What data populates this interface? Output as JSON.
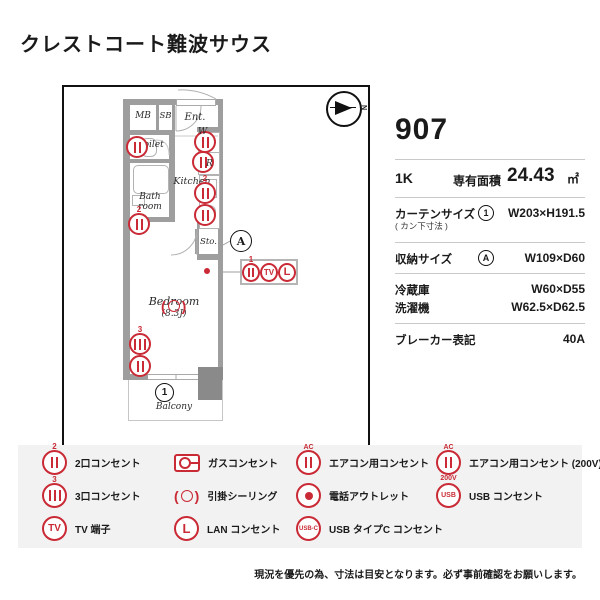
{
  "title": "クレストコート難波サウス",
  "info": {
    "room_number": "907",
    "layout": "1K",
    "area_label": "専有面積",
    "area_value": "24.43",
    "area_unit": "㎡",
    "curtain_label": "カーテンサイズ",
    "curtain_sublabel": "( カン下寸法 )",
    "curtain_ref": "1",
    "curtain_value": "W203×H191.5",
    "storage_label": "収納サイズ",
    "storage_ref": "A",
    "storage_value": "W109×D60",
    "fridge_label": "冷蔵庫",
    "fridge_value": "W60×D55",
    "washer_label": "洗濯機",
    "washer_value": "W62.5×D62.5",
    "breaker_label": "ブレーカー表記",
    "breaker_value": "40A"
  },
  "plan": {
    "compass": "N",
    "rooms": {
      "mb": "MB",
      "sb": "SB",
      "ent": "Ent.",
      "toilet": "Toilet",
      "kitchen": "Kitchen",
      "bath_line1": "Bath",
      "bath_line2": "room",
      "storage": "Sto.",
      "bedroom": "Bedroom",
      "bedroom_size": "(8.3J)",
      "balcony": "Balcony"
    },
    "markers": {
      "washer": "W",
      "fridge": "R",
      "storage_ref": "A",
      "balcony_ref": "1",
      "kitchen_outlet_count": "2",
      "bath_outlet_count": "2",
      "bedroom_outlet_count": "3",
      "callout_outlet_count": "1",
      "tv": "TV",
      "lan": "L"
    }
  },
  "legend": {
    "items": [
      {
        "label": "2口コンセント",
        "count": "2"
      },
      {
        "label": "ガスコンセント"
      },
      {
        "label": "エアコン用コンセント",
        "top": "AC"
      },
      {
        "label": "エアコン用コンセント (200V)",
        "top": "AC",
        "bottom": "200V"
      },
      {
        "label": "3口コンセント",
        "count": "3"
      },
      {
        "label": "引掛シーリング"
      },
      {
        "label": "電話アウトレット"
      },
      {
        "label": "USB コンセント",
        "text": "USB"
      },
      {
        "label": "TV 端子",
        "text": "TV"
      },
      {
        "label": "LAN コンセント",
        "text": "L"
      },
      {
        "label": "USB タイプC コンセント",
        "text": "USB-C"
      }
    ]
  },
  "footer": "現況を優先の為、寸法は目安となります。必ず事前確認をお願いします。",
  "colors": {
    "accent_red": "#c92a35",
    "wall_gray": "#9e9e9e",
    "pillar_gray": "#8a8a8a",
    "legend_bg": "#f2f2f2"
  }
}
